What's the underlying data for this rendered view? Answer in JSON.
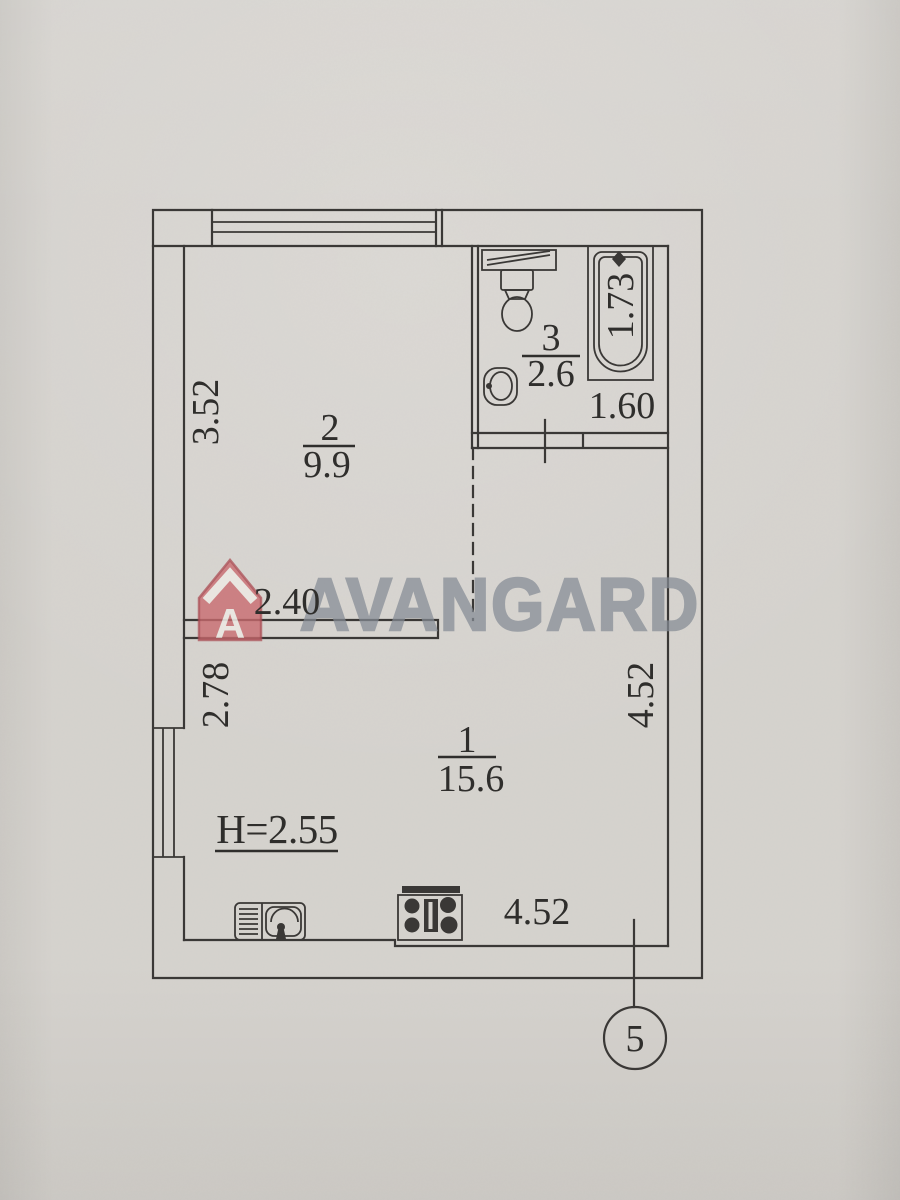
{
  "watermark": {
    "brand": "AVANGARD",
    "logo_letter": "A"
  },
  "rooms": {
    "room1": {
      "number": "1",
      "area": "15.6"
    },
    "room2": {
      "number": "2",
      "area": "9.9"
    },
    "room3": {
      "number": "3",
      "area": "2.6"
    }
  },
  "dimensions": {
    "room2_depth": "3.52",
    "room2_width": "2.40",
    "room1_left": "2.78",
    "room1_right": "4.52",
    "room1_bottom": "4.52",
    "bathroom_width": "1.60",
    "bathtub_length": "1.73",
    "ceiling_height": "H=2.55"
  },
  "marker": {
    "section_number": "5"
  },
  "colors": {
    "paper": "#d6d3ce",
    "ink": "#3a3836",
    "watermark_text": "#858c95",
    "logo_red": "#c86a6e"
  }
}
